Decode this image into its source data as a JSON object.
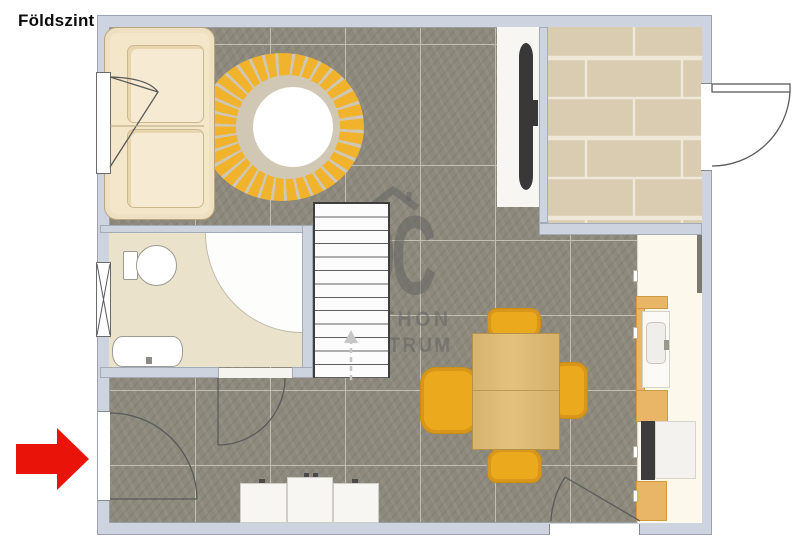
{
  "header": {
    "floor_label": "Földszint"
  },
  "watermark": {
    "logo_text": "OC",
    "brand_line1": "OTTHON",
    "brand_line2": "CENTRUM"
  },
  "colors": {
    "accent_red": "#e91309",
    "wall_fill": "#cdd3df",
    "floor_tile": "#8e897d",
    "terrace_tile": "#d9ccb1",
    "bathroom_floor": "#eae2cb",
    "rug_yellow": "#f1b22c",
    "chair_yellow": "#eba91e",
    "table_wood": "#dcba74",
    "counter_wood": "#e9b566",
    "watermark_gray": "#666666"
  },
  "icons": {
    "entrance_arrow": "red arrow pointing right at main entrance",
    "stairs_direction": "dashed walk line with up arrow",
    "watermark_roof": "house roof chevron"
  }
}
